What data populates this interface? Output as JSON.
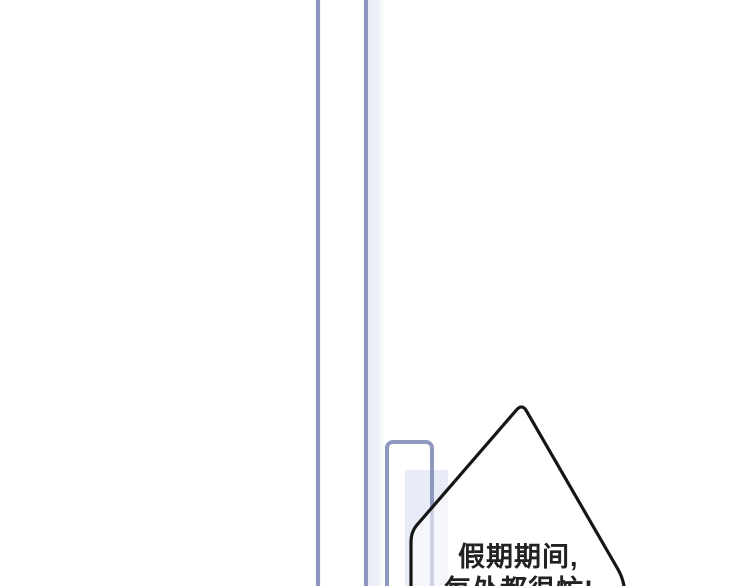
{
  "panel": {
    "bubble": {
      "line1": "假期期间,",
      "line2": "每处都很忙!"
    },
    "colors": {
      "background": "#ffffff",
      "frame_line": "#8d97bf",
      "tint": "#e7ecf8",
      "bubble_outline": "#151515",
      "bubble_fill": "rgba(255,255,255,0.55)",
      "text": "#222222"
    }
  }
}
